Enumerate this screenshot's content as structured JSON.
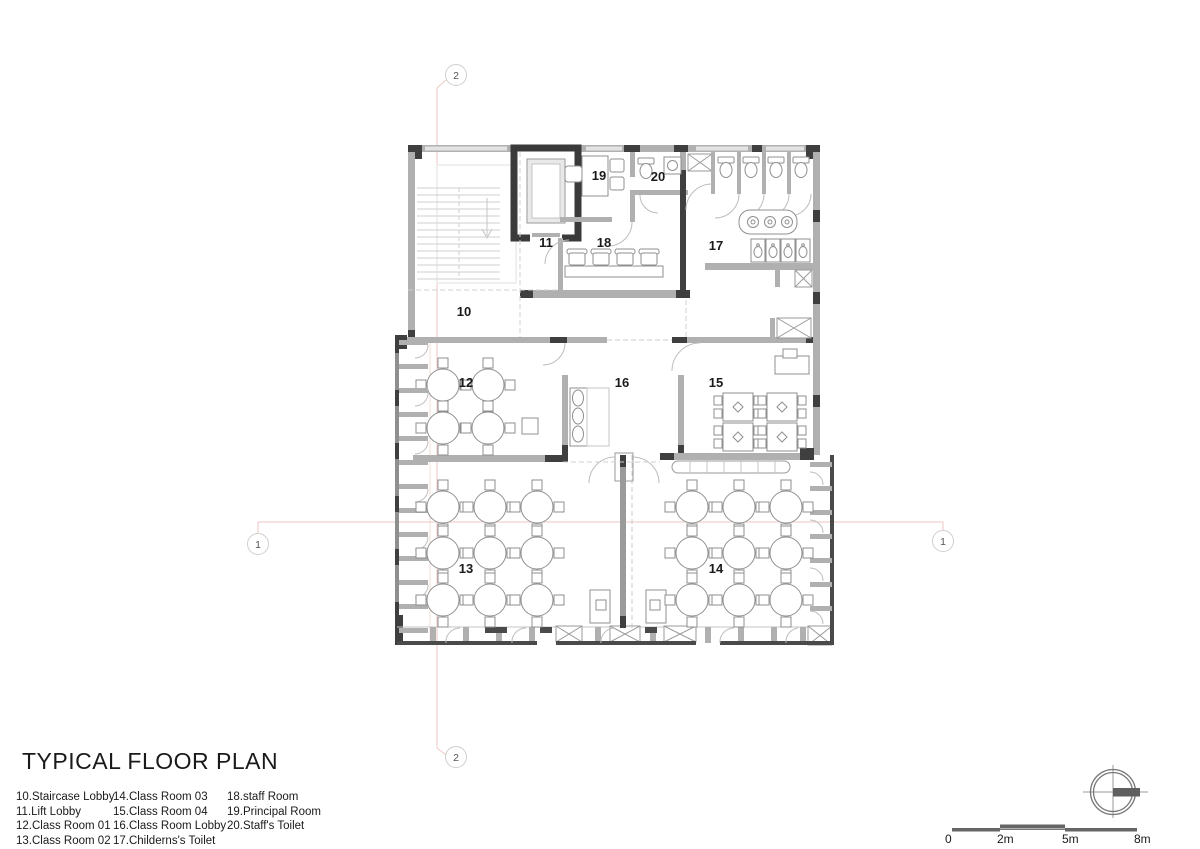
{
  "title": "TYPICAL FLOOR PLAN",
  "legend": {
    "columns": [
      [
        "10.Staircase Lobby",
        "11.Lift Lobby",
        "12.Class Room 01",
        "13.Class Room 02"
      ],
      [
        "14.Class Room 03",
        "15.Class Room 04",
        "16.Class Room Lobby",
        "17.Childerns's Toilet"
      ],
      [
        "18.staff Room",
        "19.Principal Room",
        "20.Staff's Toilet"
      ]
    ]
  },
  "rooms": [
    {
      "number": "10",
      "name": "Staircase Lobby"
    },
    {
      "number": "11",
      "name": "Lift Lobby"
    },
    {
      "number": "12",
      "name": "Class Room 01"
    },
    {
      "number": "13",
      "name": "Class Room 02"
    },
    {
      "number": "14",
      "name": "Class Room 03"
    },
    {
      "number": "15",
      "name": "Class Room 04"
    },
    {
      "number": "16",
      "name": "Class Room Lobby"
    },
    {
      "number": "17",
      "name": "Childerns's Toilet"
    },
    {
      "number": "18",
      "name": "staff Room"
    },
    {
      "number": "19",
      "name": "Principal Room"
    },
    {
      "number": "20",
      "name": "Staff's Toilet"
    }
  ],
  "grid": {
    "top": "2",
    "bottom": "2",
    "left": "1",
    "right": "1"
  },
  "scale_bar": {
    "labels": [
      "0",
      "2m",
      "5m",
      "8m"
    ]
  },
  "colors": {
    "wall_gray": "#b0b0b0",
    "wall_dark": "#3f3f3f",
    "furniture_stroke": "#8f8f8f",
    "grid_pink": "#eec7c3",
    "light_line": "#cfcfcf"
  }
}
